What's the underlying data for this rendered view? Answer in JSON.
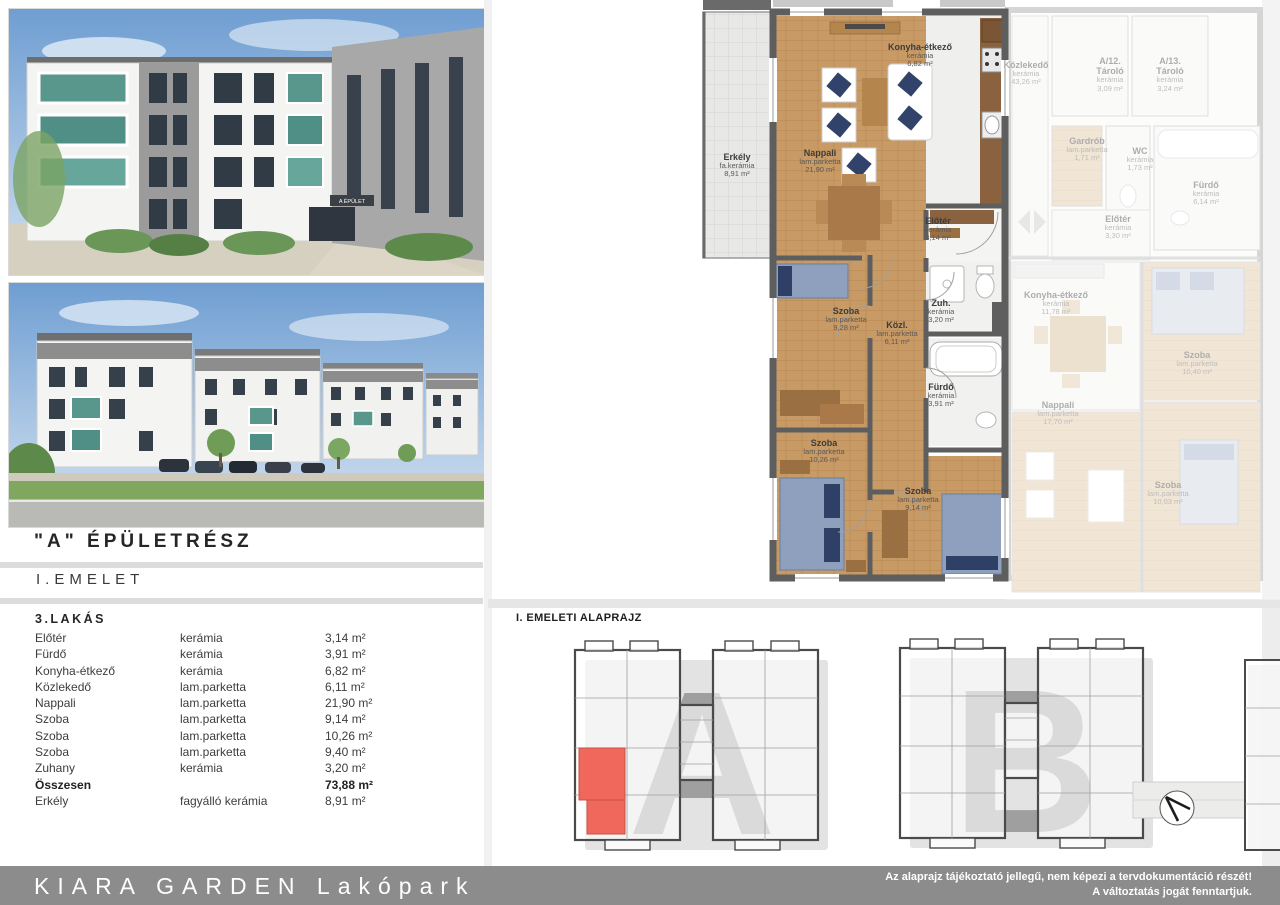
{
  "header": {
    "building_heading": "\"A\" ÉPÜLETRÉSZ",
    "floor_heading": "I.EMELET"
  },
  "renders": {
    "photo1_sign": "A ÉPÜLET"
  },
  "apartment_table": {
    "title": "3.LAKÁS",
    "rows": [
      {
        "room": "Előtér",
        "material": "kerámia",
        "area": "3,14 m²"
      },
      {
        "room": "Fürdő",
        "material": "kerámia",
        "area": "3,91 m²"
      },
      {
        "room": "Konyha-étkező",
        "material": "kerámia",
        "area": "6,82 m²"
      },
      {
        "room": "Közlekedő",
        "material": "lam.parketta",
        "area": "6,11 m²"
      },
      {
        "room": "Nappali",
        "material": "lam.parketta",
        "area": "21,90 m²"
      },
      {
        "room": "Szoba",
        "material": "lam.parketta",
        "area": "9,14 m²"
      },
      {
        "room": "Szoba",
        "material": "lam.parketta",
        "area": "10,26 m²"
      },
      {
        "room": "Szoba",
        "material": "lam.parketta",
        "area": "9,40 m²"
      },
      {
        "room": "Zuhany",
        "material": "kerámia",
        "area": "3,20 m²"
      },
      {
        "room": "Összesen",
        "material": "",
        "area": "73,88 m²"
      },
      {
        "room": "Erkély",
        "material": "fagyálló kerámia",
        "area": "8,91 m²"
      }
    ]
  },
  "floor_plan": {
    "unit_rooms": [
      {
        "name": "Erkély",
        "material": "fa.kerámia",
        "area": "8,91 m²"
      },
      {
        "name": "Nappali",
        "material": "lam.parketta",
        "area": "21,90 m²"
      },
      {
        "name": "Konyha-étkező",
        "material": "kerámia",
        "area": "6,82 m²"
      },
      {
        "name": "Előtér",
        "material": "kerámia",
        "area": "3,14 m²"
      },
      {
        "name": "Szoba",
        "material": "lam.parketta",
        "area": "9,28 m²"
      },
      {
        "name": "Közl.",
        "material": "lam.parketta",
        "area": "6,11 m²"
      },
      {
        "name": "Zuh.",
        "material": "kerámia",
        "area": "3,20 m²"
      },
      {
        "name": "Fürdő",
        "material": "kerámia",
        "area": "3,91 m²"
      },
      {
        "name": "Szoba",
        "material": "lam.parketta",
        "area": "10,26 m²"
      },
      {
        "name": "Szoba",
        "material": "lam.parketta",
        "area": "9,14 m²"
      }
    ],
    "adjacent_rooms": [
      {
        "name": "Közlekedő",
        "material": "kerámia",
        "area": "43,26 m²"
      },
      {
        "name": "A/12.",
        "name2": "Tároló",
        "material": "kerámia",
        "area": "3,09 m²"
      },
      {
        "name": "A/13.",
        "name2": "Tároló",
        "material": "kerámia",
        "area": "3,24 m²"
      },
      {
        "name": "Gardrób",
        "material": "lam.parketta",
        "area": "1,71 m²"
      },
      {
        "name": "WC",
        "material": "kerámia",
        "area": "1,73 m²"
      },
      {
        "name": "Fürdő",
        "material": "kerámia",
        "area": "6,14 m²"
      },
      {
        "name": "Előtér",
        "material": "kerámia",
        "area": "3,30 m²"
      },
      {
        "name": "Konyha-étkező",
        "material": "kerámia",
        "area": "11,78 m²"
      },
      {
        "name": "Szoba",
        "material": "lam.parketta",
        "area": "10,40 m²"
      },
      {
        "name": "Nappali",
        "material": "lam.parketta",
        "area": "17,70 m²"
      },
      {
        "name": "Szoba",
        "material": "lam.parketta",
        "area": "10,03 m²"
      }
    ]
  },
  "site_plan": {
    "caption": "I. EMELETI ALAPRAJZ",
    "building_a_letter": "A",
    "building_b_letter": "B",
    "highlight_color": "#f0685c"
  },
  "footer": {
    "brand": "KIARA GARDEN Lakópark",
    "disclaimer_line1": "Az alaprajz tájékoztató jellegű, nem képezi a tervdokumentáció részét!",
    "disclaimer_line2": "A változtatás jogát fenntartjuk."
  },
  "colors": {
    "footer_bg": "#8c8c8c",
    "wall": "#5e5e5e",
    "wood_floor": "#c79a66",
    "balcony_glass": "#4f8f86",
    "highlight_red": "#f0685c"
  }
}
